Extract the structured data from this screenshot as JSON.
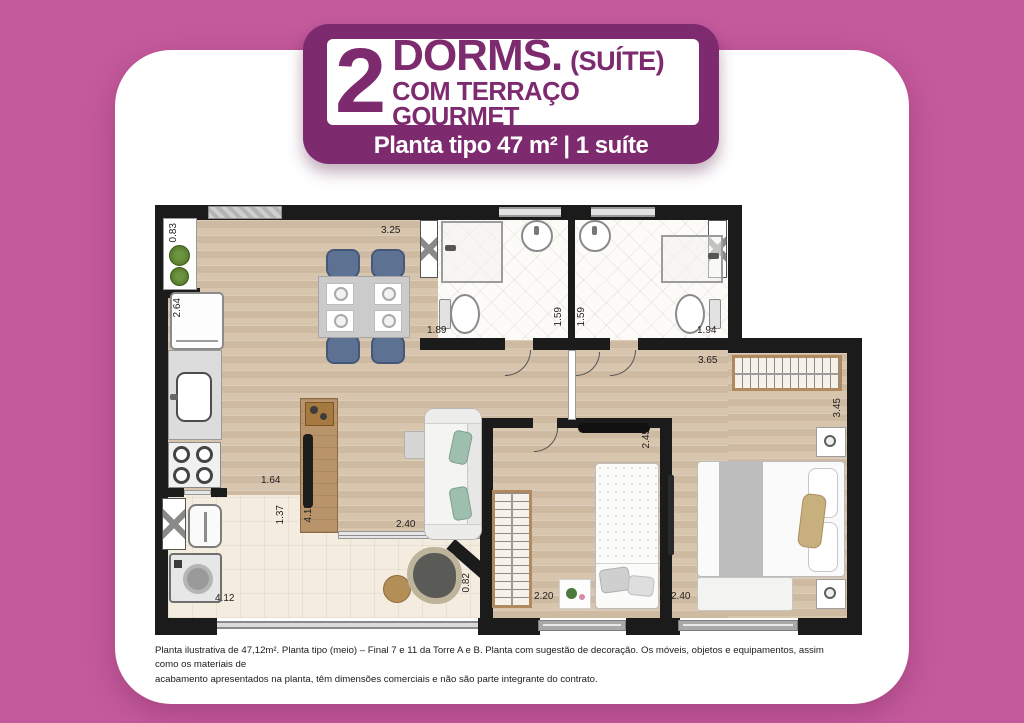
{
  "header": {
    "number": "2",
    "title": "DORMS.",
    "suffix": "(SUÍTE)",
    "line2": "COM TERRAÇO GOURMET",
    "subtitle": "Planta tipo 47 m² | 1 suíte"
  },
  "plan": {
    "dims": {
      "plants_ledge": "0.83",
      "kitchen_depth": "2.64",
      "living_width": "3.25",
      "bath1_width": "1.89",
      "bath1_depth": "1.59",
      "bath2_depth": "1.59",
      "bath2_width": "1.94",
      "suite_width": "3.65",
      "suite_depth": "3.45",
      "kitchen_width": "1.64",
      "laundry_width": "1.37",
      "living_length": "4.15",
      "living_bottom": "2.40",
      "dorm2_depth": "2.45",
      "dorm2_width": "2.20",
      "suite_bottom": "2.40",
      "terrace_length": "4.12",
      "terrace_width": "0.82"
    }
  },
  "footer": {
    "text": "Planta ilustrativa de 47,12m². Planta tipo (meio) – Final 7 e 11 da Torre A e B. Planta com sugestão de decoração. Os móveis, objetos e equipamentos, assim como os materiais de\nacabamento apresentados na planta, têm dimensões comerciais e não são parte integrante do contrato."
  },
  "colors": {
    "background_pink": "#c45a9c",
    "badge_purple": "#7d2a6f",
    "wall_black": "#1b1b1b"
  }
}
